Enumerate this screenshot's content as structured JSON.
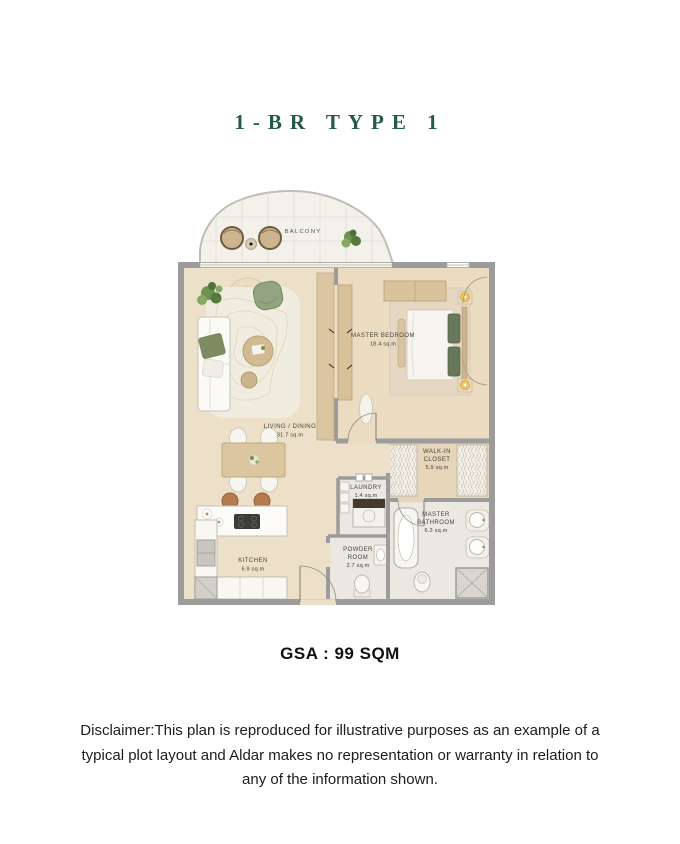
{
  "page": {
    "title": "1-BR TYPE 1",
    "gsa": "GSA : 99 SQM",
    "disclaimer": "Disclaimer:This plan is reproduced for illustrative purposes as an example of a typical plot layout and Aldar makes no representation or warranty in relation to any of the information shown."
  },
  "rooms": {
    "balcony": {
      "name": "BALCONY"
    },
    "living_dining": {
      "name": "LIVING / DINING",
      "area": "31.7 sq.m"
    },
    "master_bedroom": {
      "name": "MASTER BEDROOM",
      "area": "18.4 sq.m"
    },
    "walk_in_closet": {
      "name_line1": "WALK-IN",
      "name_line2": "CLOSET",
      "area": "5.9 sq.m"
    },
    "laundry": {
      "name": "LAUNDRY",
      "area": "1.4 sq.m"
    },
    "master_bathroom": {
      "name_line1": "MASTER",
      "name_line2": "BATHROOM",
      "area": "6.3 sq.m"
    },
    "powder_room": {
      "name_line1": "POWDER",
      "name_line2": "ROOM",
      "area": "2.7 sq.m"
    },
    "kitchen": {
      "name": "KITCHEN",
      "area": "6.9 sq.m"
    }
  },
  "colors": {
    "title_green": "#265a49",
    "wall_gray": "#9c9c9c",
    "wood_floor": "#ece0c9",
    "bedroom_floor": "#ebdcc1",
    "tile": "#eae8e1",
    "accent_green": "#92a482",
    "balcony_fill": "#f3f1ea"
  }
}
